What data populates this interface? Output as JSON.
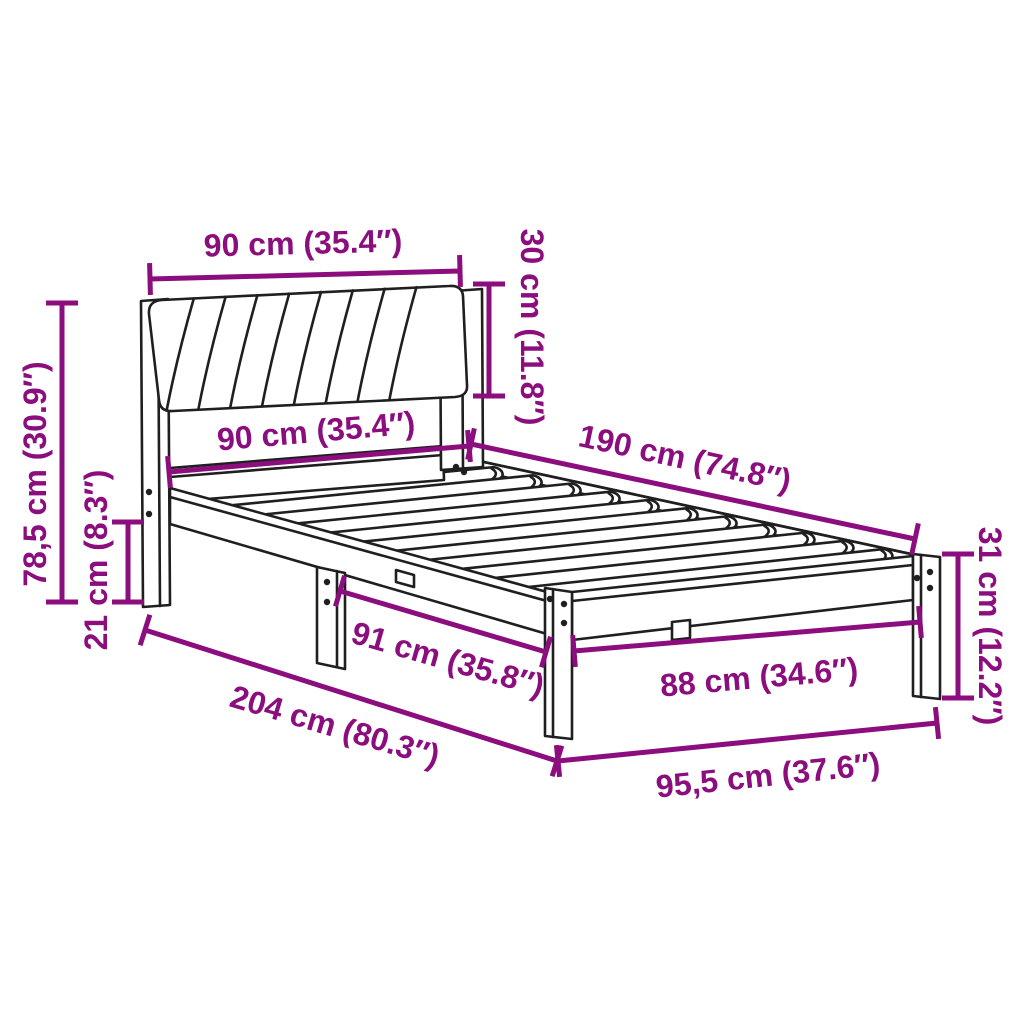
{
  "diagram": {
    "product": "Bed frame with upholstered headboard",
    "style": "technical dimension line drawing",
    "background_color": "#ffffff",
    "line_color": "#1f1f1f",
    "dimension_color": "#8b0d7e",
    "labels": {
      "headboard_width_top": "90 cm (35.4″)",
      "cushion_height": "30 cm (11.8″)",
      "overall_height": "78,5 cm (30.9″)",
      "frame_width": "90 cm (35.4″)",
      "mattress_length": "190 cm (74.8″)",
      "underbed_clearance": "21 cm (8.3″)",
      "footend_height": "31 cm (12.2″)",
      "leg_spacing": "91 cm (35.8″)",
      "footend_inner_width": "88 cm (34.6″)",
      "overall_length": "204 cm (80.3″)",
      "overall_width": "95,5 cm (37.6″)"
    }
  }
}
